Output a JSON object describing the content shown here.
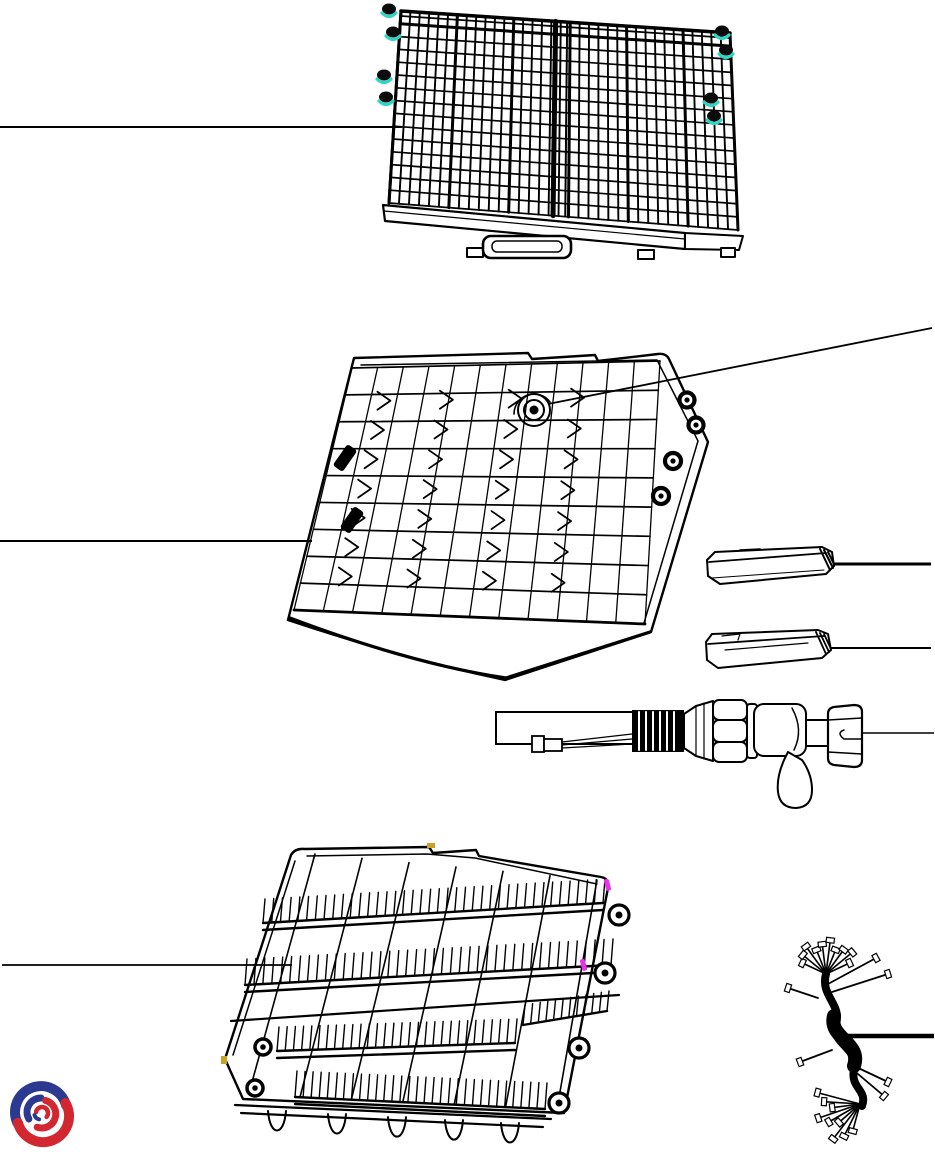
{
  "page": {
    "title": "Dishwasher racks exploded parts diagram",
    "background": "#ffffff",
    "line_color": "#000000"
  },
  "colors": {
    "roller_teal": "#2fd6c3",
    "roller_magenta": "#e832e8",
    "marker_yellow": "#c9a227",
    "logo_blue": "#2b3990",
    "logo_red": "#d22630"
  },
  "parts": {
    "upper_rack": {
      "label": "Upper rack assembly",
      "callout_side": "left"
    },
    "middle_rack": {
      "label": "Middle rack assembly",
      "callout_side": "left"
    },
    "rack_fitting": {
      "label": "Middle rack water feed fitting",
      "callout_side": "right"
    },
    "rail_cap_a": {
      "label": "Rack slide rail cap (upper)",
      "callout_side": "right"
    },
    "rail_cap_b": {
      "label": "Rack slide rail cap (lower)",
      "callout_side": "right"
    },
    "inlet_hose": {
      "label": "Water inlet hose with aquastop valve",
      "callout_side": "right"
    },
    "lower_rack": {
      "label": "Lower rack assembly",
      "callout_side": "left"
    },
    "wire_harness": {
      "label": "Wiring harness",
      "callout_side": "right"
    },
    "logo": {
      "label": "Manufacturer logo"
    }
  }
}
